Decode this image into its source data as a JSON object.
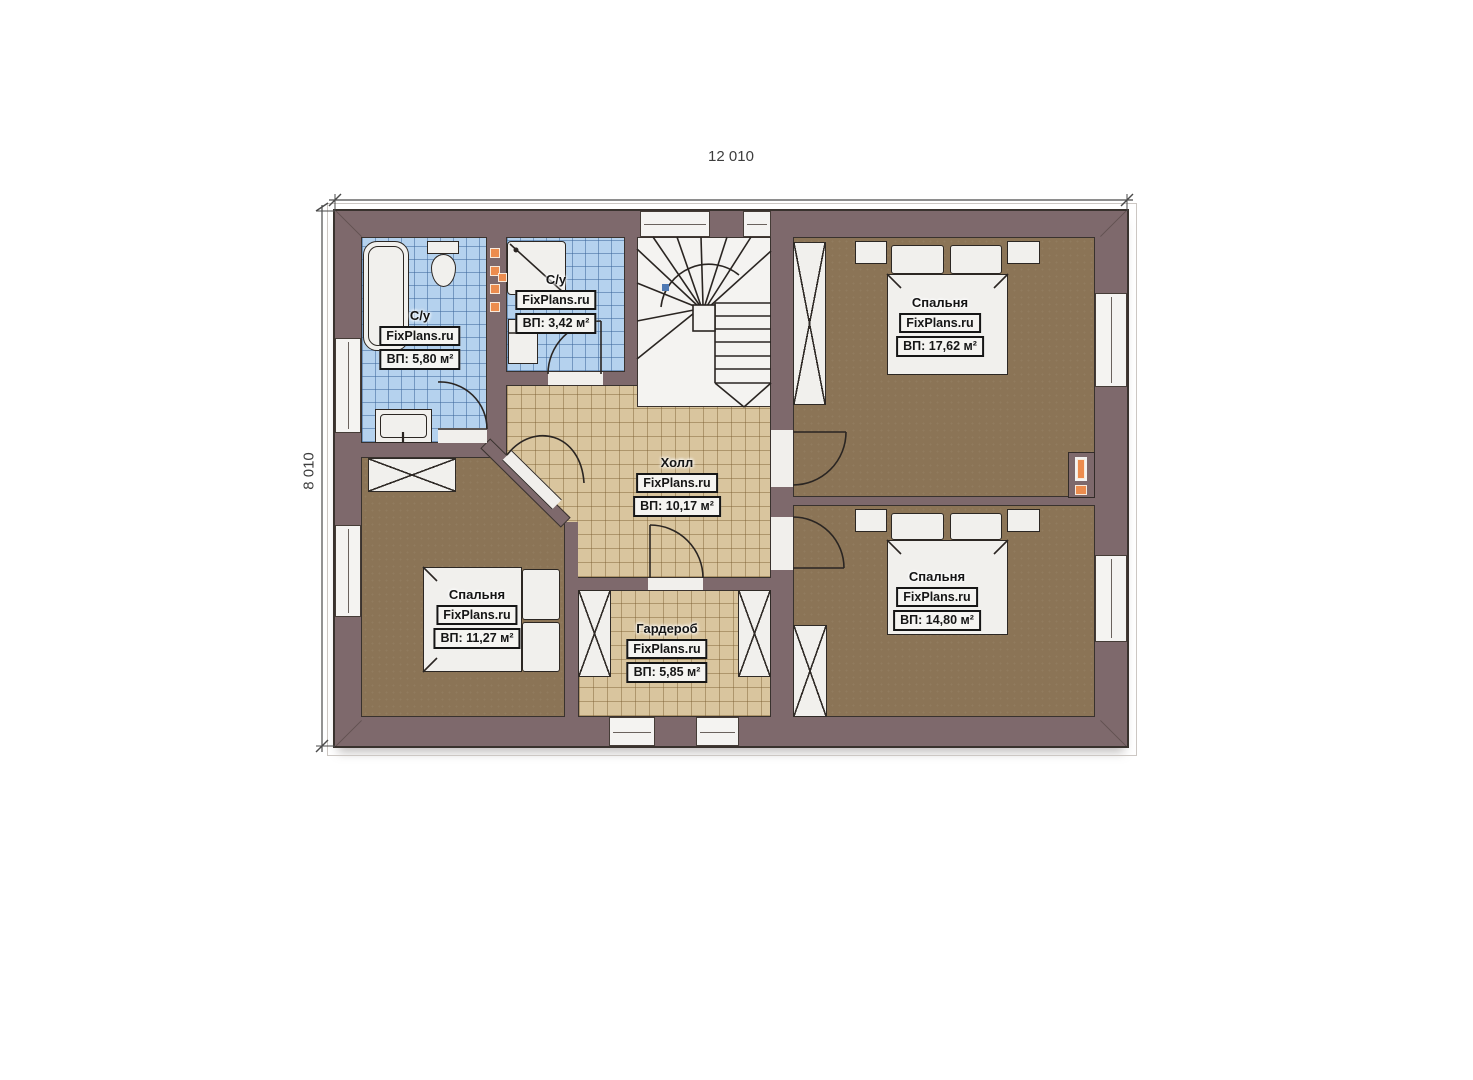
{
  "plan": {
    "title": "Second floor plan",
    "dimension_width": "12 010",
    "dimension_height": "8 010"
  },
  "rooms": {
    "bath_left": {
      "name": "С/у",
      "brand": "FixPlans.ru",
      "area": "ВП: 5,80 м²"
    },
    "bath_top": {
      "name": "С/у",
      "brand": "FixPlans.ru",
      "area": "ВП: 3,42 м²"
    },
    "bedroom_top_right": {
      "name": "Спальня",
      "brand": "FixPlans.ru",
      "area": "ВП: 17,62 м²"
    },
    "hall": {
      "name": "Холл",
      "brand": "FixPlans.ru",
      "area": "ВП: 10,17 м²"
    },
    "bedroom_bottom_left": {
      "name": "Спальня",
      "brand": "FixPlans.ru",
      "area": "ВП: 11,27 м²"
    },
    "wardrobe": {
      "name": "Гардероб",
      "brand": "FixPlans.ru",
      "area": "ВП: 5,85 м²"
    },
    "bedroom_bottom_right": {
      "name": "Спальня",
      "brand": "FixPlans.ru",
      "area": "ВП: 14,80 м²"
    }
  },
  "colors": {
    "wall": "#7e696c",
    "bathroom_tile": "#b5d2ee",
    "hall_tile": "#d9c59e",
    "bedroom_floor": "#8b7456",
    "accent_orange": "#ec8c4e",
    "outline": "#39322e"
  }
}
